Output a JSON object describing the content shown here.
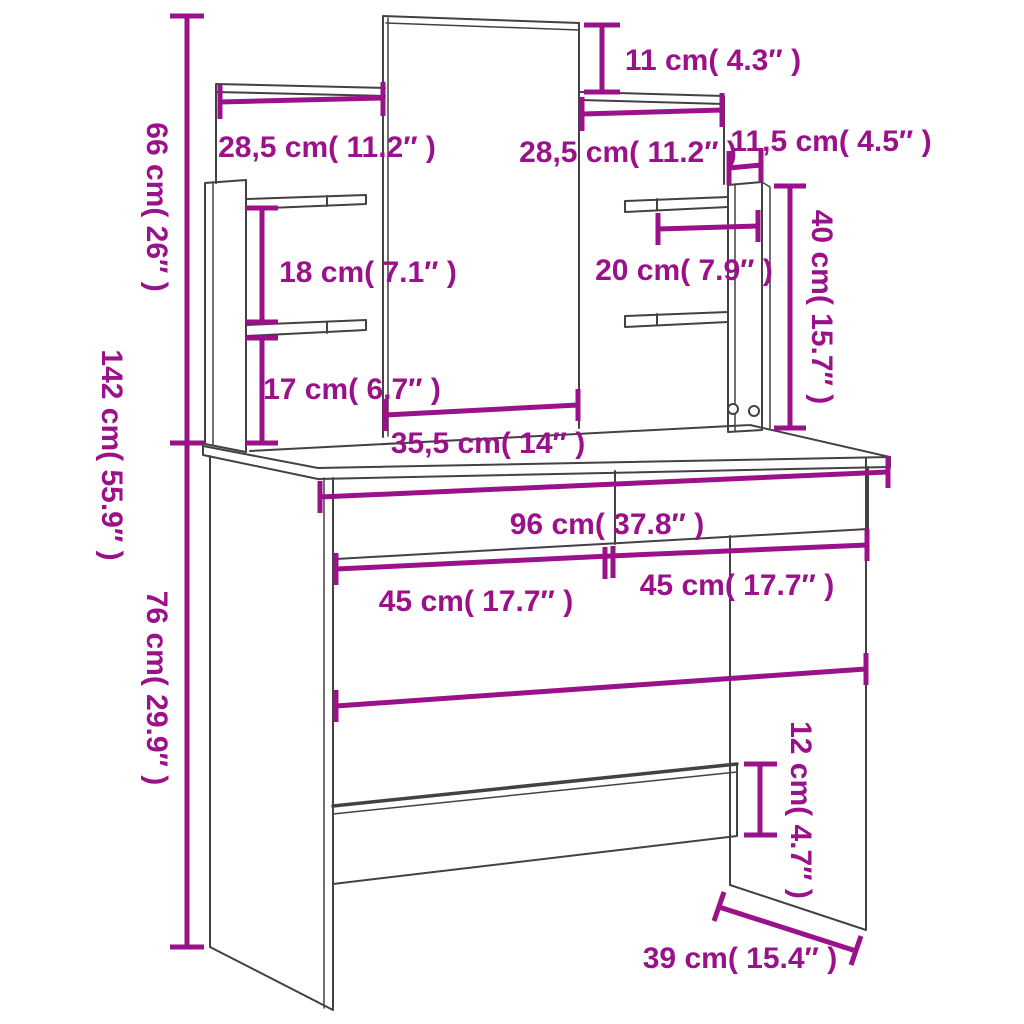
{
  "diagram": {
    "type": "furniture-dimension-drawing",
    "product": "dressing table with mirror and shelves",
    "colors": {
      "accent": "#9A1189",
      "outline": "#454045",
      "background": "#ffffff"
    },
    "dimensions": {
      "total_height": "142 cm( 55.9″ )",
      "hutch_height": "66 cm( 26″ )",
      "desk_height": "76 cm( 29.9″ )",
      "left_shelf_width": "28,5 cm( 11.2″ )",
      "mirror_overhang": "11 cm( 4.3″ )",
      "right_shelf_width": "28,5 cm( 11.2″ )",
      "side_panel_depth": "11,5 cm( 4.5″ )",
      "left_shelf_gap": "18 cm( 7.1″ )",
      "right_shelf_depth": "20 cm( 7.9″ )",
      "right_hutch_height": "40 cm( 15.7″ )",
      "mirror_to_table": "17 cm( 6.7″ )",
      "mirror_width": "35,5 cm( 14″ )",
      "table_width": "96 cm( 37.8″ )",
      "left_drawer_width": "45 cm( 17.7″ )",
      "right_drawer_width": "45 cm( 17.7″ )",
      "crossbar_height": "12 cm( 4.7″ )",
      "table_depth": "39 cm( 15.4″ )"
    }
  }
}
